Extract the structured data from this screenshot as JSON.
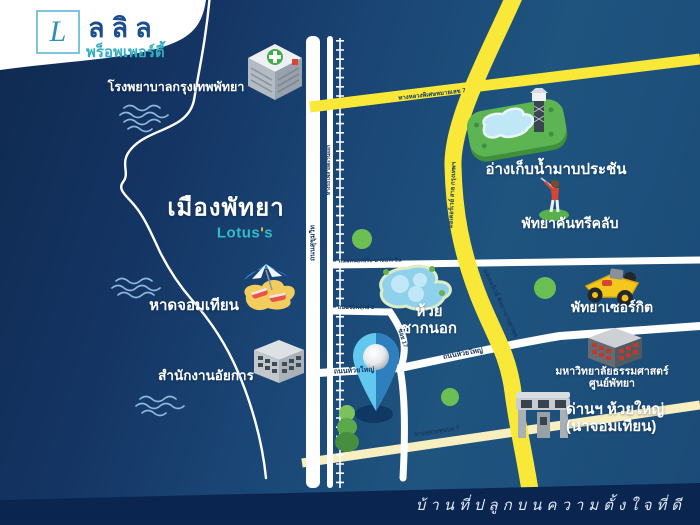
{
  "logo": {
    "mark": "L",
    "name": "ลลิล",
    "subtitle": "พร็อพเพอร์ตี้"
  },
  "slogan": "บ้านที่ปลูกบนความตั้งใจที่ดี",
  "city": "เมืองพัทยา",
  "lotus": {
    "word": "Lotus",
    "apos": "'",
    "s": "s"
  },
  "places": {
    "hospital": "โรงพยาบาลกรุงเทพพัทยา",
    "reservoir": "อ่างเก็บน้ำมาบประชัน",
    "country_club": "พัทยาคันทรีคลับ",
    "beach": "หาดจอมเทียน",
    "circuit": "พัทยาเซอร์กิต",
    "pond_line1": "ห้วย",
    "pond_line2": "ชากนอก",
    "attorney": "สำนักงานอัยการ",
    "university_line1": "มหาวิทยาลัยธรรมศาสตร์",
    "university_line2": "ศูนย์พัทยา",
    "toll_line1": "ด่านฯ ห้วยใหญ่",
    "toll_line2": "(นาจอมเทียน)"
  },
  "roads": {
    "sukhumvit": "ถนนสุขุมวิท",
    "railway": "ทางรถไฟสายตะวันออก",
    "motorway7": "ทางหลวงพิเศษหมายเลข 7",
    "motorway_v1": "มอเตอร์เวย์ สาย กรุงเทพฯ",
    "motorway_v2": "มอเตอร์เวย์ พัทยา-มาบตาพุด",
    "road_a": "ถนนหนองปรือ-มาบประชัน",
    "chaiyapruek": "ถนนชัยพฤกษ์ 2",
    "soi": "ซอย 17",
    "huai_yai": "ถนนห้วยใหญ่",
    "rural": "ทางหลวงชนบท 7"
  },
  "colors": {
    "motorway_yellow": "#f9e838",
    "rural_yellow": "#f7efc0",
    "navy_bar": "#0a2650",
    "map_blue": "#1a4574",
    "brand_blue": "#1b4e8e",
    "brand_teal": "#35aec2",
    "tree_green": "#6cbf52",
    "pin_light": "#62c8f0",
    "pin_dark": "#2e7fbe"
  }
}
